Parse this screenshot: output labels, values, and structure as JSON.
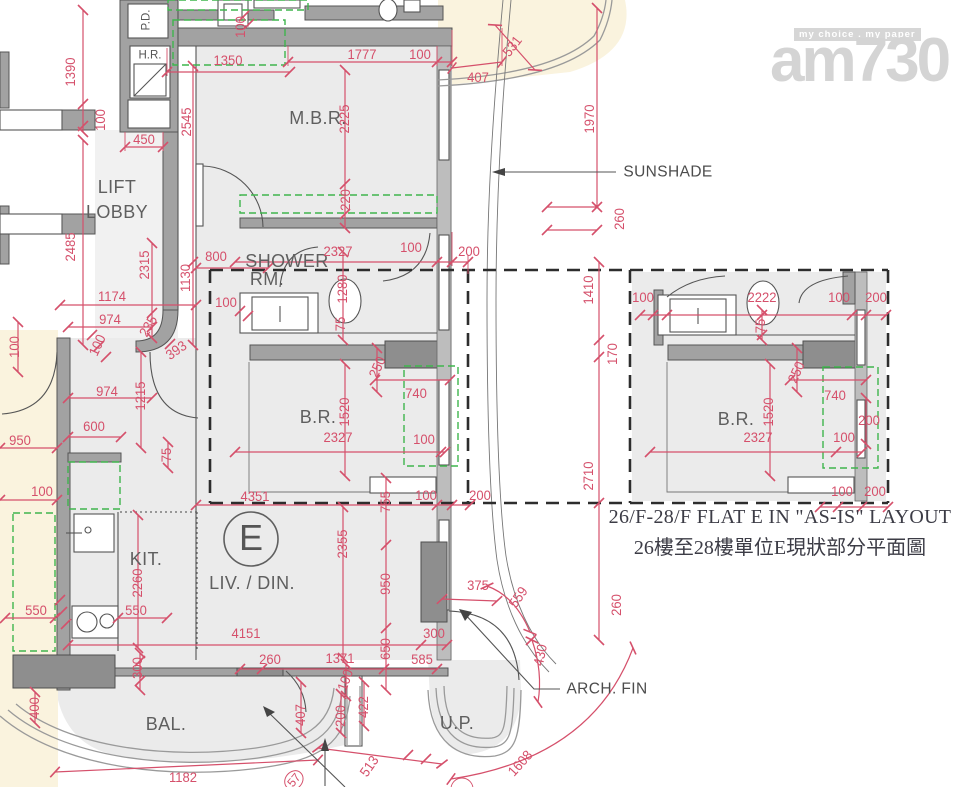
{
  "watermark": {
    "tagline": "my choice . my paper",
    "logo": "am730"
  },
  "caption": {
    "line1": "26/F-28/F FLAT E IN \"AS-IS\" LAYOUT",
    "line2": "26樓至28樓單位E現狀部分平面圖"
  },
  "labels": [
    {
      "t": "P.D.",
      "x": 147,
      "y": 20,
      "r": -90,
      "c": "small",
      "n": "room-label-pd"
    },
    {
      "t": "H.R.",
      "x": 150,
      "y": 56,
      "c": "small",
      "n": "room-label-hr"
    },
    {
      "t": "LIFT",
      "x": 117,
      "y": 187,
      "c": "room",
      "n": "room-label-lift-lobby"
    },
    {
      "t": "LOBBY",
      "x": 117,
      "y": 212,
      "c": "room",
      "n": "room-label-lift-lobby"
    },
    {
      "t": "M.B.R.",
      "x": 318,
      "y": 118,
      "c": "room",
      "n": "room-label-mbr"
    },
    {
      "t": "SHOWER",
      "x": 287,
      "y": 261,
      "c": "room",
      "n": "room-label-shower"
    },
    {
      "t": "RM.",
      "x": 267,
      "y": 279,
      "c": "room",
      "n": "room-label-shower"
    },
    {
      "t": "B.R.",
      "x": 318,
      "y": 417,
      "c": "room",
      "n": "room-label-br"
    },
    {
      "t": "KIT.",
      "x": 146,
      "y": 559,
      "c": "room",
      "n": "room-label-kit"
    },
    {
      "t": "LIV. / DIN.",
      "x": 252,
      "y": 583,
      "c": "room",
      "n": "room-label-livdin"
    },
    {
      "t": "BAL.",
      "x": 166,
      "y": 724,
      "c": "room",
      "n": "room-label-bal"
    },
    {
      "t": "U.P.",
      "x": 457,
      "y": 723,
      "c": "room",
      "n": "room-label-up"
    },
    {
      "t": "B.R.",
      "x": 736,
      "y": 419,
      "c": "room",
      "n": "room-label-br-asis"
    },
    {
      "t": "E",
      "x": 251,
      "y": 538,
      "c": "flat",
      "n": "flat-e-label"
    },
    {
      "t": "SUNSHADE",
      "x": 668,
      "y": 172,
      "c": "note",
      "n": "annotation-sunshade"
    },
    {
      "t": "ARCH. FIN",
      "x": 607,
      "y": 689,
      "c": "note",
      "n": "annotation-arch-fin"
    },
    {
      "t": "1390",
      "x": 70,
      "y": 72,
      "r": -90
    },
    {
      "t": "100",
      "x": 100,
      "y": 120,
      "r": -90
    },
    {
      "t": "450",
      "x": 144,
      "y": 139
    },
    {
      "t": "1350",
      "x": 228,
      "y": 60
    },
    {
      "t": "100",
      "x": 240,
      "y": 27,
      "r": -90
    },
    {
      "t": "2545",
      "x": 186,
      "y": 122,
      "r": -90
    },
    {
      "t": "1777",
      "x": 362,
      "y": 54
    },
    {
      "t": "100",
      "x": 420,
      "y": 54
    },
    {
      "t": "407",
      "x": 478,
      "y": 77
    },
    {
      "t": "531",
      "x": 512,
      "y": 46,
      "r": -52
    },
    {
      "t": "2225",
      "x": 344,
      "y": 119,
      "r": -90
    },
    {
      "t": "220",
      "x": 345,
      "y": 200,
      "r": -90
    },
    {
      "t": "1970",
      "x": 589,
      "y": 119,
      "r": -90
    },
    {
      "t": "260",
      "x": 619,
      "y": 219,
      "r": -90
    },
    {
      "t": "2485",
      "x": 70,
      "y": 247,
      "r": -90
    },
    {
      "t": "2315",
      "x": 144,
      "y": 265,
      "r": -90
    },
    {
      "t": "1130",
      "x": 185,
      "y": 278,
      "r": -90
    },
    {
      "t": "800",
      "x": 216,
      "y": 256
    },
    {
      "t": "1174",
      "x": 112,
      "y": 296
    },
    {
      "t": "974",
      "x": 110,
      "y": 319
    },
    {
      "t": "100",
      "x": 97,
      "y": 345,
      "r": -65
    },
    {
      "t": "974",
      "x": 107,
      "y": 391
    },
    {
      "t": "235",
      "x": 148,
      "y": 326,
      "r": -60
    },
    {
      "t": "393",
      "x": 176,
      "y": 350,
      "r": -35
    },
    {
      "t": "100",
      "x": 14,
      "y": 347,
      "r": -90
    },
    {
      "t": "1215",
      "x": 140,
      "y": 396,
      "r": -90
    },
    {
      "t": "600",
      "x": 94,
      "y": 426
    },
    {
      "t": "950",
      "x": 20,
      "y": 440
    },
    {
      "t": "75",
      "x": 166,
      "y": 455,
      "r": -90
    },
    {
      "t": "100",
      "x": 42,
      "y": 491
    },
    {
      "t": "2327",
      "x": 338,
      "y": 251
    },
    {
      "t": "100",
      "x": 411,
      "y": 247
    },
    {
      "t": "200",
      "x": 469,
      "y": 251
    },
    {
      "t": "100",
      "x": 226,
      "y": 302
    },
    {
      "t": "1280",
      "x": 342,
      "y": 289,
      "r": -90
    },
    {
      "t": "75",
      "x": 340,
      "y": 324,
      "r": -90
    },
    {
      "t": "250",
      "x": 377,
      "y": 367,
      "r": -65
    },
    {
      "t": "740",
      "x": 416,
      "y": 393
    },
    {
      "t": "1520",
      "x": 344,
      "y": 412,
      "r": -90
    },
    {
      "t": "2327",
      "x": 338,
      "y": 437
    },
    {
      "t": "100",
      "x": 424,
      "y": 439
    },
    {
      "t": "4351",
      "x": 255,
      "y": 496
    },
    {
      "t": "755",
      "x": 385,
      "y": 502,
      "r": -90
    },
    {
      "t": "100",
      "x": 426,
      "y": 495
    },
    {
      "t": "200",
      "x": 480,
      "y": 495
    },
    {
      "t": "2355",
      "x": 342,
      "y": 544,
      "r": -90
    },
    {
      "t": "950",
      "x": 385,
      "y": 584,
      "r": -90
    },
    {
      "t": "650",
      "x": 385,
      "y": 649,
      "r": -90
    },
    {
      "t": "375",
      "x": 478,
      "y": 585
    },
    {
      "t": "559",
      "x": 518,
      "y": 597,
      "r": -55
    },
    {
      "t": "430",
      "x": 540,
      "y": 655,
      "r": -78
    },
    {
      "t": "260",
      "x": 616,
      "y": 605,
      "r": -90
    },
    {
      "t": "2260",
      "x": 137,
      "y": 583,
      "r": -90
    },
    {
      "t": "550",
      "x": 36,
      "y": 610
    },
    {
      "t": "550",
      "x": 136,
      "y": 610
    },
    {
      "t": "300",
      "x": 137,
      "y": 668,
      "r": -90
    },
    {
      "t": "400",
      "x": 34,
      "y": 708,
      "r": -90
    },
    {
      "t": "4151",
      "x": 246,
      "y": 633
    },
    {
      "t": "300",
      "x": 434,
      "y": 633
    },
    {
      "t": "260",
      "x": 270,
      "y": 659
    },
    {
      "t": "1371",
      "x": 340,
      "y": 658
    },
    {
      "t": "585",
      "x": 422,
      "y": 659
    },
    {
      "t": "407",
      "x": 300,
      "y": 715,
      "r": -90
    },
    {
      "t": "200",
      "x": 340,
      "y": 716,
      "r": -90
    },
    {
      "t": "422",
      "x": 363,
      "y": 707,
      "r": -90
    },
    {
      "t": "100",
      "x": 345,
      "y": 680,
      "r": -70
    },
    {
      "t": "513",
      "x": 369,
      "y": 766,
      "r": -55
    },
    {
      "t": "1608",
      "x": 520,
      "y": 763,
      "r": -48
    },
    {
      "t": "1182",
      "x": 183,
      "y": 777
    },
    {
      "t": "57",
      "x": 294,
      "y": 780,
      "r": -50,
      "c": "circ"
    },
    {
      "t": "1410",
      "x": 588,
      "y": 290,
      "r": -90
    },
    {
      "t": "170",
      "x": 612,
      "y": 354,
      "r": -90
    },
    {
      "t": "2710",
      "x": 588,
      "y": 476,
      "r": -90
    },
    {
      "t": "100",
      "x": 643,
      "y": 297
    },
    {
      "t": "2222",
      "x": 762,
      "y": 297
    },
    {
      "t": "100",
      "x": 839,
      "y": 297
    },
    {
      "t": "200",
      "x": 876,
      "y": 297
    },
    {
      "t": "75",
      "x": 760,
      "y": 326,
      "r": -90
    },
    {
      "t": "250",
      "x": 796,
      "y": 372,
      "r": -65
    },
    {
      "t": "740",
      "x": 835,
      "y": 395
    },
    {
      "t": "1520",
      "x": 768,
      "y": 412,
      "r": -90
    },
    {
      "t": "2327",
      "x": 758,
      "y": 437
    },
    {
      "t": "100",
      "x": 844,
      "y": 437
    },
    {
      "t": "200",
      "x": 869,
      "y": 420
    },
    {
      "t": "100",
      "x": 842,
      "y": 491
    },
    {
      "t": "200",
      "x": 875,
      "y": 491
    }
  ]
}
